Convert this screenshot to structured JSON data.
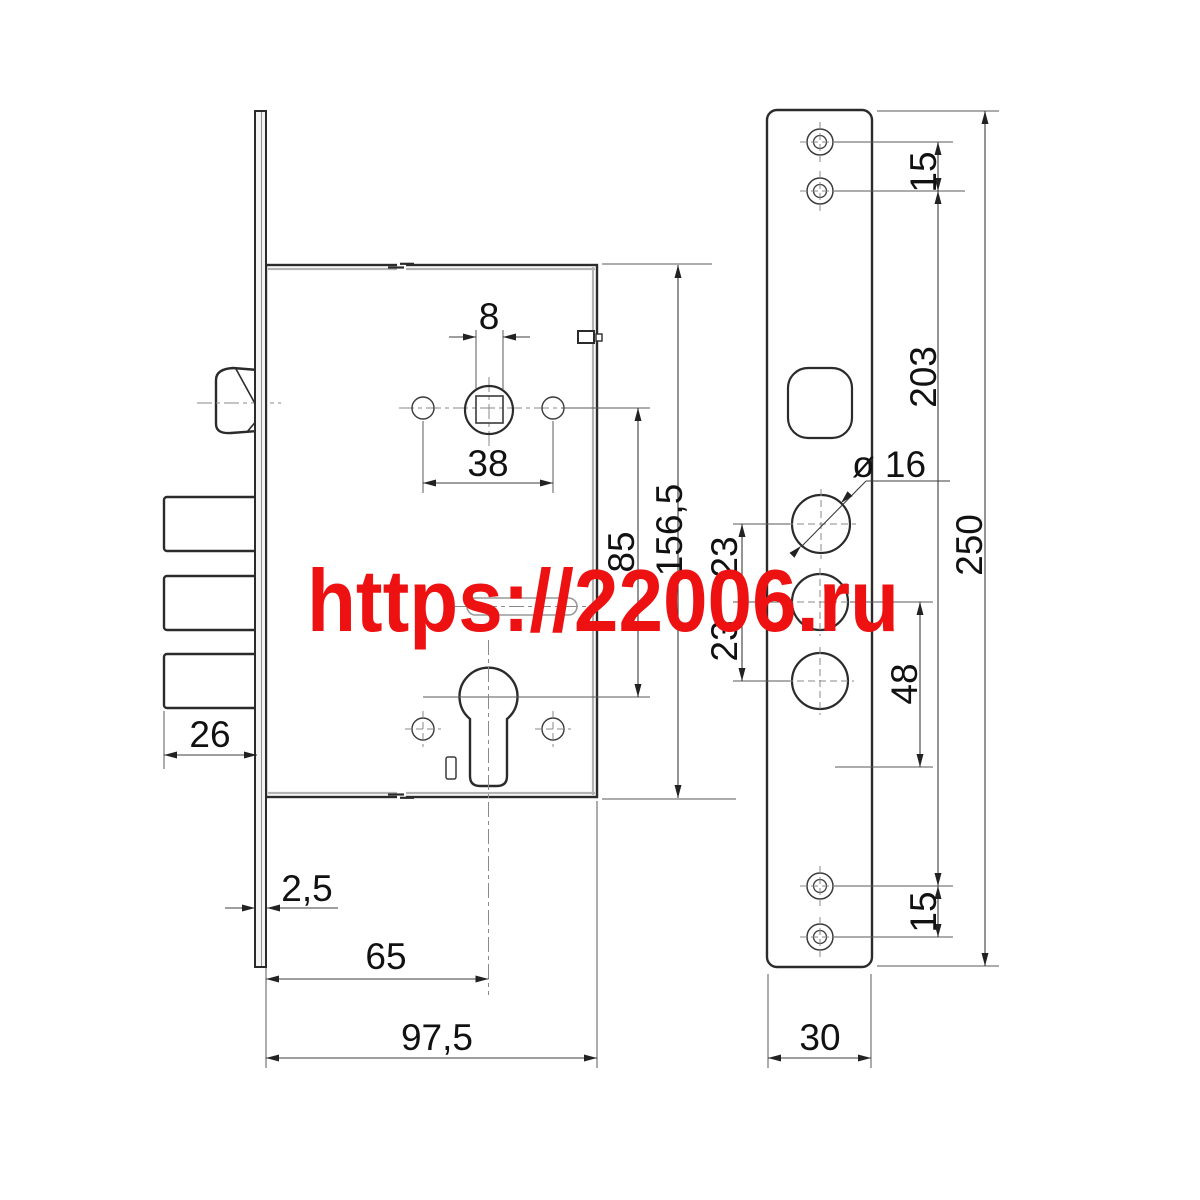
{
  "watermark": {
    "text": "https://22006.ru",
    "color": "#ee1111"
  },
  "dims": {
    "spindle_square_width": "8",
    "handle_hole_spacing": "38",
    "spindle_to_cylinder": "85",
    "body_height": "156,5",
    "bolt_throw": "26",
    "faceplate_thickness": "2,5",
    "backset": "65",
    "body_depth": "97,5",
    "top_screw_spacing": "15",
    "screw_span": "203",
    "plate_height": "250",
    "cylinder_hole_diameter": "ø 16",
    "hole_gap_upper": "23",
    "hole_gap_lower": "23",
    "hole_to_screw": "48",
    "bottom_screw_spacing": "15",
    "plate_width": "30"
  }
}
